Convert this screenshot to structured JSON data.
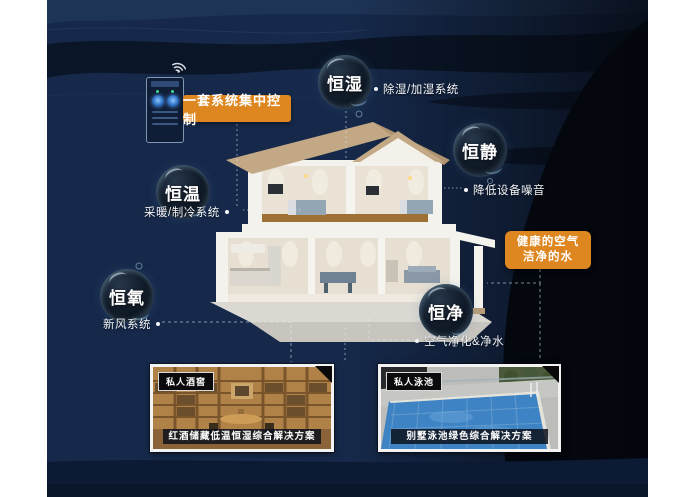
{
  "poster": {
    "theme": "smart-home constant-environment system diagram",
    "colors": {
      "accent_orange": "#de861f",
      "bg_navy": "#16294a",
      "bg_dark_band": "#0a1527",
      "bg_black_right": "#04080f",
      "text_white": "#ffffff"
    },
    "icons": [
      "wifi-icon"
    ]
  },
  "badges": {
    "central_control": "一套系统集中控制",
    "healthy_air_line1": "健康的空气",
    "healthy_air_line2": "洁净的水"
  },
  "bubbles": [
    {
      "label": "恒湿",
      "note": "除湿/加湿系统"
    },
    {
      "label": "恒静",
      "note": "降低设备噪音"
    },
    {
      "label": "恒温",
      "note": "采暖/制冷系统"
    },
    {
      "label": "恒氧",
      "note": "新风系统"
    },
    {
      "label": "恒净",
      "note": "空气净化&净水"
    }
  ],
  "cards": [
    {
      "tag": "私人酒窖",
      "caption": "红酒储藏低温恒湿综合解决方案"
    },
    {
      "tag": "私人泳池",
      "caption": "别墅泳池绿色综合解决方案"
    }
  ]
}
